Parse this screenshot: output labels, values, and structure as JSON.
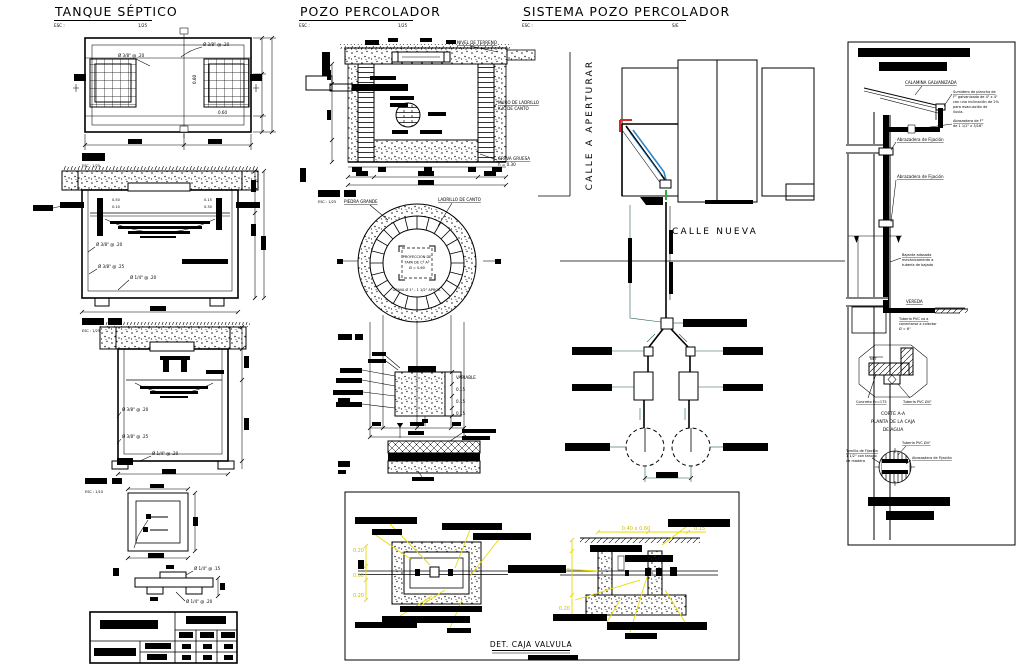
{
  "scales": {
    "s25": "ESC : 1/25",
    "s10": "ESC : 1/10"
  },
  "tanque": {
    "title": "TANQUE SÉPTICO",
    "esc_label": "ESC :",
    "esc_value": "1/25",
    "plan": {
      "callout_top": "Ø 3/8\" @ .20",
      "callout_left": "Ø 3/8\" @ .20",
      "dim_v": "0.60",
      "dim_h": "0.60"
    },
    "section": {
      "d1": "0.50",
      "d2": "0.10",
      "d3": "0.15",
      "d4": "0.30",
      "callout_1": "Ø 3/8\" @ .20",
      "callout_2": "Ø 3/8\" @ .25",
      "callout_3": "Ø 1/4\" @ .20"
    },
    "cross": {
      "callout_1": "Ø 3/8\" @ .20",
      "callout_2": "Ø 3/8\" @ .25",
      "callout_3": "Ø 1/4\" @ .20"
    },
    "tapa": {
      "callout_top": "Ø 1/4\" @ .15",
      "callout_bottom": "Ø 1/4\" @ .20"
    }
  },
  "pozo": {
    "title": "POZO PERCOLADOR",
    "esc_label": "ESC :",
    "esc_value": "1/25",
    "section": {
      "label_nivel": "NIVEL DE TERRENO",
      "label_muro_1": "MURO DE LADRILLO",
      "label_muro_2": "K.K. DE CANTO",
      "label_grava_1": "GRAVA GRUESA",
      "label_grava_2": "h = 0.30"
    },
    "plan": {
      "label_piedra": "PIEDRA GRANDE",
      "label_ladrillo": "LADRILLO DE CANTO",
      "center_1": "PROYECCION DE",
      "center_2": "TAPA DE Cº Aº",
      "center_3": "Ø = 0.60",
      "center_note": "GRAVA Ø 1\" - 1 1/2\" APROX."
    },
    "detail": {
      "dim_variable": "VARIABLE",
      "dim_15a": "0.15",
      "dim_15b": "0.15",
      "dim_15c": "0.15"
    }
  },
  "sistema": {
    "title": "SISTEMA POZO PERCOLADOR",
    "esc_label": "ESC :",
    "esc_value": "S/E",
    "calle_aperturar": "CALLE A APERTURAR",
    "calle_nueva": "CALLE NUEVA"
  },
  "caja": {
    "title": "DET. CAJA VALVULA",
    "plan_dims": {
      "d1": "0.20",
      "d2": "0.60",
      "d3": "0.20"
    },
    "sec_dims": {
      "top": "0.40 x 0.60",
      "right": "0.15",
      "left": "0.40",
      "bottom": "0.20"
    }
  },
  "bajante": {
    "roof_label": "CALAMINA GALVANIZADA",
    "sumidero_note": [
      "Sumidero de plancha de",
      "F° galvanizado de 4\" x 4\"",
      "con una inclinación de 2%",
      "para evacuación de",
      "lluvia."
    ],
    "canal_note": [
      "Abrazadera de F°",
      "de 1 1/2\" x 3/16\""
    ],
    "abrazadera_1": "Abrazadera de Fijación",
    "abrazadera_2": "Abrazadera de Fijación",
    "bajante_note": [
      "Bajante adosada",
      "mecánicamente a",
      "tubería de bajada"
    ],
    "vereda": "VEREDA",
    "pvc_note": [
      "Tubería PVC va a",
      "conectarse a colector",
      "Ø = 6\""
    ],
    "corte": [
      "CORTE A-A",
      "PLANTA DE LA CAJA",
      "DE AGUA"
    ],
    "concreto": "Concreto f'c=175",
    "tuberia_4": "Tubería PVC Ø4\"",
    "npt": "NPT",
    "circle_tuberia": "Tubería PVC Ø4\"",
    "circle_abrazadera": "Abrazadera de Fijación",
    "tornillo_note": [
      "Tornillo de Fijación",
      "1 1/2\" con tarugo",
      "de madera"
    ]
  }
}
